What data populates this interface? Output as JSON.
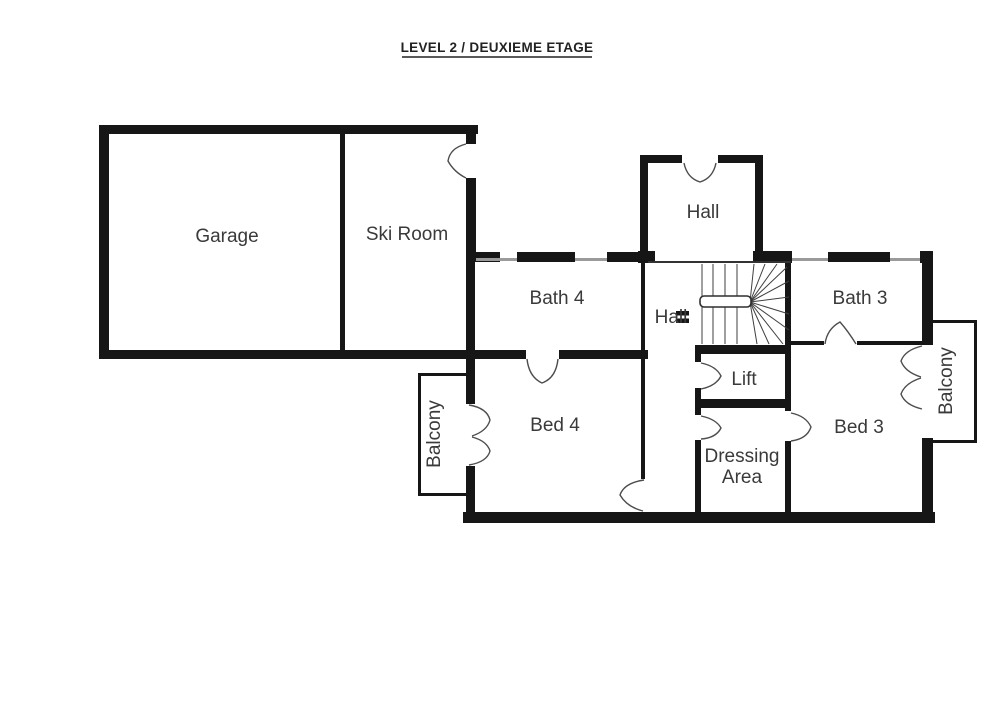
{
  "title": "LEVEL 2 / DEUXIEME ETAGE",
  "rooms": {
    "garage": "Garage",
    "ski_room": "Ski Room",
    "hall_upper": "Hall",
    "bath4": "Bath 4",
    "hall_lower": "Hall",
    "bath3": "Bath 3",
    "lift": "Lift",
    "bed4": "Bed 4",
    "bed3": "Bed 3",
    "dressing_line1": "Dressing",
    "dressing_line2": "Area",
    "balcony_left": "Balcony",
    "balcony_right": "Balcony"
  },
  "colors": {
    "wall": "#161616",
    "label": "#3a3a3a",
    "line": "#4d4d4d",
    "background": "#ffffff"
  }
}
